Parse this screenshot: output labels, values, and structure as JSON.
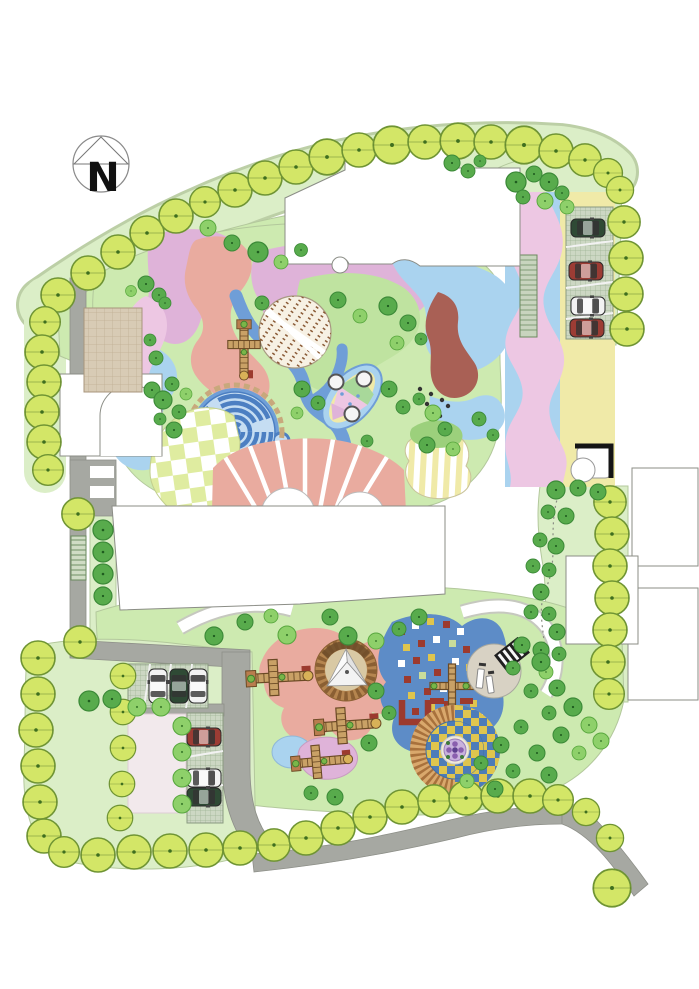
{
  "meta": {
    "title": "Residential landscape site plan",
    "drawing_type": "color master-plan rendering"
  },
  "compass": {
    "label": "N"
  },
  "palette": {
    "road": "#a6a8a2",
    "roadEdge": "#8d8f88",
    "lawnLight": "#dbeec7",
    "lawnMid": "#cdeab0",
    "lawnEdge": "#b3c89c",
    "treeBorderFill": "#d3e667",
    "treeBorderEdge": "#6f9434",
    "treeDark": "#58ab4c",
    "treeDarkEdge": "#3c8a38",
    "treeLight": "#8ed06a",
    "treeLightEdge": "#58a73e",
    "lavender": "#dfb3d9",
    "pinkBand": "#edc7e3",
    "salmon": "#e9ab9f",
    "skyBlue": "#aad3ef",
    "pathBlue": "#6f9ed7",
    "mazeWall": "#4c7fc2",
    "mazeBg": "#c5ddf2",
    "maroon": "#a96055",
    "brickRed": "#9c3a2e",
    "paleYellow": "#f0eaa8",
    "checkerGreen": "#dfeca0",
    "tanPaving": "#d8cbb5",
    "pavers": "#ccd7c3",
    "paverLine": "#9db394",
    "sandRing": "#b5854f",
    "sandInner": "#d9c9a4",
    "rubberBlue": "#5d8cc7",
    "checkerYellow": "#dfc54e",
    "checkerBlue": "#4d7cb8",
    "plazaGray": "#d8d2c4",
    "playEquip": "#c9a166",
    "playEquipEdge": "#6b4a25",
    "carWhite": "#f2f2f2",
    "carRed": "#9c3c34",
    "carDarkGreen": "#2f4a35",
    "outline": "#8b8d86",
    "compassInk": "#111111"
  },
  "parking": {
    "north_lot": {
      "stalls": 4,
      "cars": [
        "dark-green",
        "red",
        "white",
        "red"
      ]
    },
    "southwest_lot_top_row": {
      "stalls": 4,
      "cars": [
        "white",
        "dark-green",
        "white"
      ]
    },
    "southwest_lot_side_row": {
      "stalls": 4,
      "cars": [
        "red",
        "white",
        "dark-green"
      ]
    }
  },
  "features": [
    "north-arrow compass",
    "perimeter street-tree border",
    "site access roads",
    "residential building footprints",
    "tan paved entry plaza",
    "circular hedge maze",
    "checkerboard plaza",
    "radial paved plaza with scalloped edge",
    "leaf-vein paving circle",
    "leaf-shaped planter with seat stones",
    "winding blue walkway",
    "sand pit with shade sail",
    "toddler climbing structures",
    "blue rubber play surface with mosaic squares",
    "piano-stair plaza with benches",
    "checker target circle with spiral center",
    "grass-paver parking stalls with cars",
    "garden gazebo",
    "lawns with scattered trees"
  ]
}
